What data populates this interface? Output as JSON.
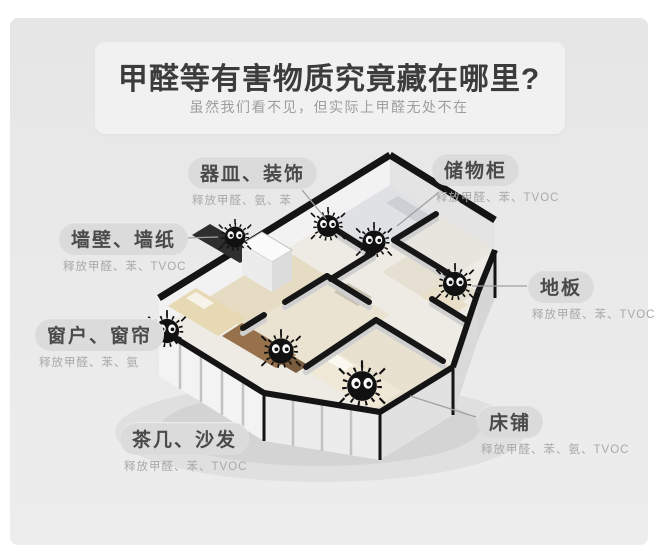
{
  "page": {
    "title": "甲醛等有害物质究竟藏在哪里?",
    "subtitle": "虽然我们看不见，但实际上甲醛无处不在"
  },
  "labels": [
    {
      "id": "vessels",
      "name": "器皿、装饰",
      "sub": "释放甲醛、氨、苯"
    },
    {
      "id": "cabinet",
      "name": "储物柜",
      "sub": "释放甲醛、苯、TVOC"
    },
    {
      "id": "wall",
      "name": "墙壁、墙纸",
      "sub": "释放甲醛、苯、TVOC"
    },
    {
      "id": "floor",
      "name": "地板",
      "sub": "释放甲醛、苯、TVOC"
    },
    {
      "id": "window",
      "name": "窗户、窗帘",
      "sub": "释放甲醛、苯、氨"
    },
    {
      "id": "bed",
      "name": "床铺",
      "sub": "释放甲醛、苯、氨、TVOC"
    },
    {
      "id": "sofa",
      "name": "茶几、沙发",
      "sub": "释放甲醛、苯、TVOC"
    }
  ],
  "icons": {
    "dust_sprite": "black fuzzy formaldehyde monster with white eyes",
    "dust_sprite_count": "7"
  },
  "colors": {
    "panel_bg": "#e9e9e9",
    "title_text": "#3c3c3c",
    "subtitle_text": "#9e9e9e",
    "pill_bg": "#dbdbdb",
    "pill_text": "#4a4a4a",
    "sub_text": "#a9a9a9",
    "wall_top": "#141414",
    "wall_face": "#f2f2f2",
    "floor_beige": "#e5dcc3",
    "sofa_brown": "#96714b",
    "sprite_black": "#111111"
  }
}
